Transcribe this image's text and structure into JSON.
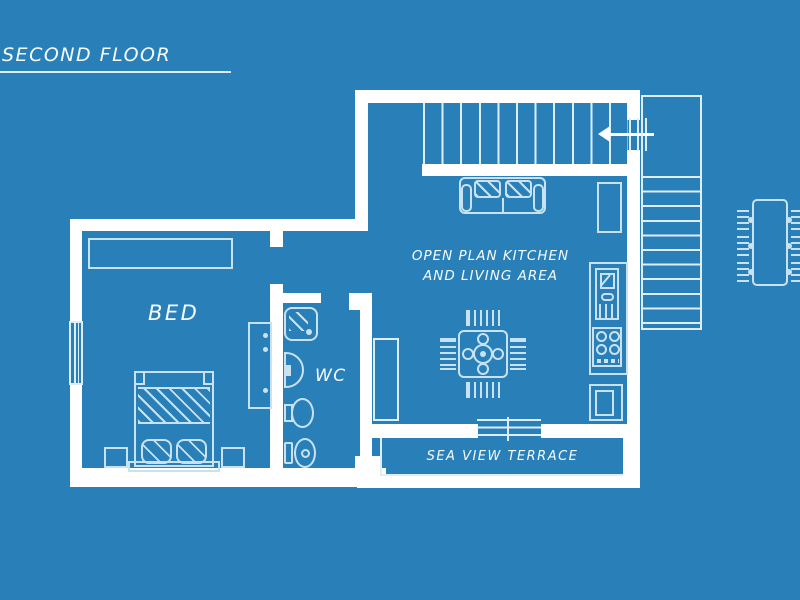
{
  "title": "SECOND FLOOR",
  "rooms": {
    "bedroom": {
      "label": "BED"
    },
    "wc": {
      "label": "WC"
    },
    "living": {
      "line1": "OPEN PLAN KITCHEN",
      "line2": "AND LIVING AREA"
    },
    "terrace": {
      "label": "SEA VIEW TERRACE"
    }
  },
  "colors": {
    "background": "#2980b9",
    "walls": "#ffffff",
    "furniture_outline": "#c9e2f2",
    "thin_lines": "#ddeef8",
    "text": "#f6fbfe"
  },
  "icons": {
    "stairs-direction-arrow": "left"
  },
  "furniture": [
    "wardrobe",
    "dresser",
    "double-bed",
    "nightstand",
    "shower",
    "washbasin",
    "bidet",
    "toilet",
    "sofa",
    "tv-cabinet",
    "dining-table-with-chairs",
    "kitchen-tall-cabinet",
    "kitchen-counter",
    "kitchen-sink-unit",
    "hob",
    "appliance",
    "interior-staircase",
    "exterior-staircase",
    "terrace-steps",
    "outdoor-dining-table"
  ]
}
